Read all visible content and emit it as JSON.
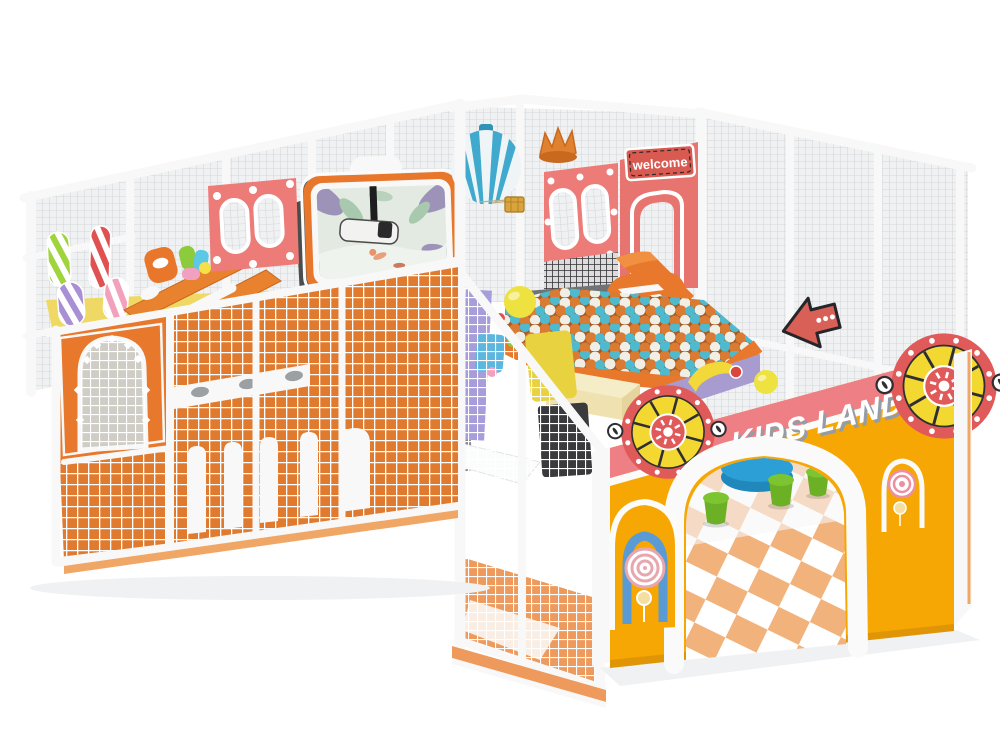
{
  "meta": {
    "width": 1000,
    "height": 733,
    "title": "KIDS LAND indoor soft-play playground — 3D product render"
  },
  "signs": {
    "welcome": "welcome",
    "brand": "KIDS LAND"
  },
  "palette": {
    "background": "#ffffff",
    "fence_white": "#f7f8f7",
    "net_grey": "#d3d7d9",
    "mesh_orange": "#e07a2e",
    "structure_orange": "#e8782b",
    "wall_yellow": "#f6a703",
    "stripe_pink": "#ee7f85",
    "panel_coral": "#ed7b78",
    "sign_red": "#d85a50",
    "ball_orange": "#d97b33",
    "ball_teal": "#4fb9ce",
    "ball_white": "#f1eee6",
    "ball_yellow": "#ede23f",
    "balloon_blue": "#3faacd",
    "stool_green": "#7dc530",
    "table_blue": "#2c9fd6",
    "mat_orange": "#f2b27c",
    "wheel_red": "#e05a5a",
    "wheel_yellow": "#f2d830",
    "arrow_red": "#d96057",
    "lollipop_blue": "#5b9bd5",
    "screen_mint": "#e2eae2"
  },
  "elements": {
    "fences": "white safety fence frames with grey netting",
    "mesh_walls": "orange panels with white rope mesh and arch column decorations",
    "ball_pit": "ball pit filled with orange, teal and white balls",
    "balloon": "blue and white striped hot-air balloon with hanging basket",
    "tower": "pink welcome tower with crown, oval windows and welcome sign",
    "screen": "orange-framed cartoon billboard screen with ceiling projector",
    "punch_bags": "candy striped soft punch bags",
    "entrance": "yellow entrance wall with KIDS LAND lettering, pink stripe, sun-wheel ornaments, arched doorway and lollipop arches",
    "furniture": "blue round table and green stools on orange-and-white puzzle mats",
    "arrow_sign": "red direction arrow sign mounted on fence rail"
  }
}
